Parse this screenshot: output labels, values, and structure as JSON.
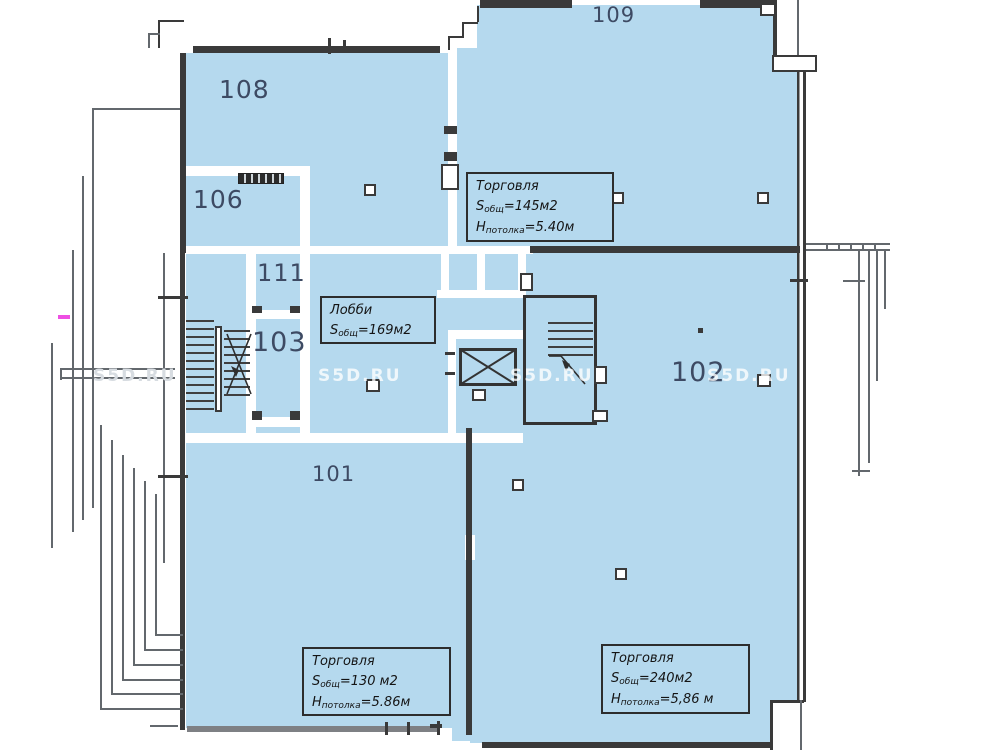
{
  "plan_title": "Floor plan",
  "rooms": {
    "r101": "101",
    "r102": "102",
    "r103": "103",
    "r106": "106",
    "r108": "108",
    "r109": "109",
    "r111": "111"
  },
  "labels": {
    "retail145": {
      "title": "Торговля",
      "area_prefix": "S",
      "area_sub": "общ",
      "area_value": "=145м2",
      "height_prefix": "H",
      "height_sub": "потолка",
      "height_value": "=5.40м"
    },
    "lobby": {
      "title": "Лобби",
      "area_prefix": "S",
      "area_sub": "общ",
      "area_value": "=169м2"
    },
    "retail130": {
      "title": "Торговля",
      "area_prefix": "S",
      "area_sub": "общ",
      "area_value": "=130 м2",
      "height_prefix": "H",
      "height_sub": "потолка",
      "height_value": "=5.86м"
    },
    "retail240": {
      "title": "Торговля",
      "area_prefix": "S",
      "area_sub": "общ",
      "area_value": "=240м2",
      "height_prefix": "H",
      "height_sub": "потолка",
      "height_value": "=5,86 м"
    }
  },
  "watermark": {
    "text": "S5D.RU"
  },
  "icons": {
    "elevator": "crossed-box",
    "stairs": "step-lines",
    "direction_arrow": "diagonal-arrow"
  },
  "colors": {
    "room_fill": "#b5d9ee",
    "wall_dark": "#3a3a3a",
    "wall_gray": "#7e8084",
    "room_number_text": "#3d4a63",
    "label_text": "#141414",
    "accent_magenta": "#ee4fe3",
    "watermark": "rgba(255,255,255,0.78)"
  }
}
